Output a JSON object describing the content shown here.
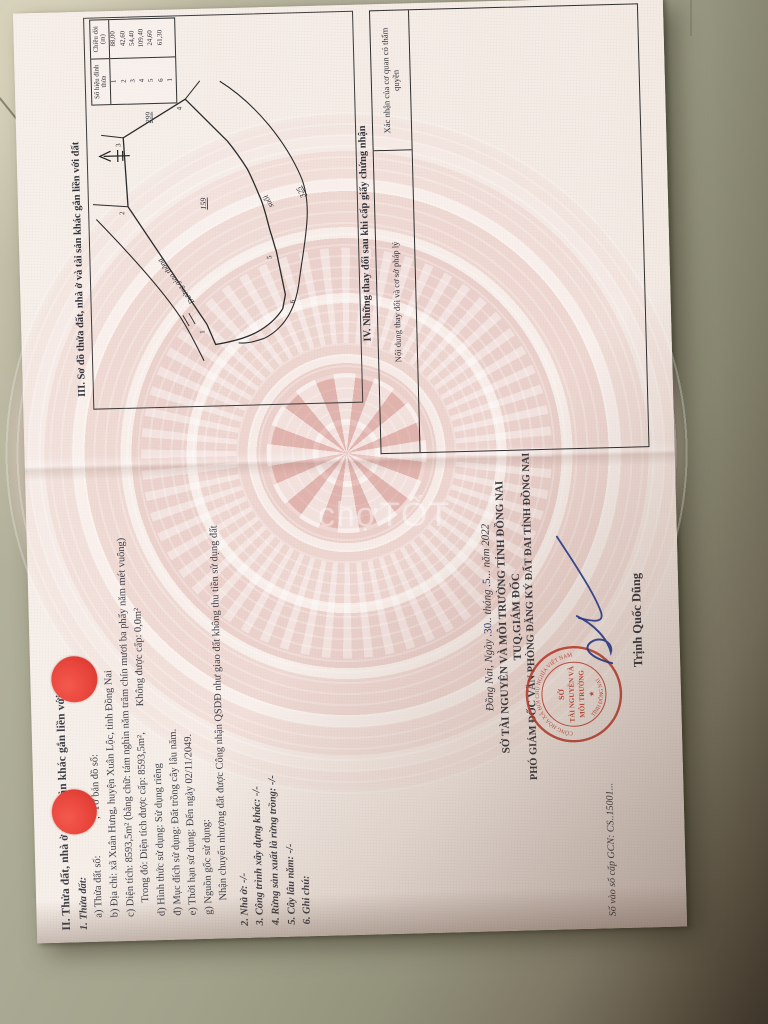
{
  "watermark": "chợTỐT",
  "floor": {
    "tile_color": "#a8a793",
    "shadow_color": "#3e352a"
  },
  "document": {
    "section2": {
      "heading": "II. Thửa đất, nhà ở và tài sản khác gắn liền với đất",
      "lines": [
        "1. Thửa đất:",
        "a) Thửa đất số:              ;  Tờ bản đồ số:",
        "b) Địa chỉ: xã Xuân Hưng, huyện Xuân Lộc, tỉnh Đồng Nai",
        "c) Diện tích: 8593,5m² (bằng chữ: tám nghìn năm trăm chín mươi ba phẩy năm mét vuông)",
        "Trong đó: Diện tích được cấp: 8593,5m²,          Không được cấp: 0,0m²",
        "d) Hình thức sử dụng: Sử dụng riêng",
        "đ) Mục đích sử dụng: Đất trồng cây lâu năm.",
        "e) Thời hạn sử dụng: Đến ngày 02/11/2049.",
        "g) Nguồn gốc sử dụng:",
        "Nhận chuyển nhượng đất được Công nhận QSDĐ như giao đất không thu tiền sử dụng đất",
        "2. Nhà ở: -/-",
        "3. Công trình xây dựng khác: -/-",
        "4. Rừng sản xuất là rừng trồng: -/-",
        "5. Cây lâu năm: -/-",
        "6. Ghi chú:"
      ]
    },
    "issuance": {
      "date_prefix": "Đồng Nai, Ngày .",
      "date_day": "30",
      "date_mid": ".. tháng .",
      "date_month": "5",
      "date_suffix": "... năm 2022",
      "agency": "SỞ TÀI NGUYÊN VÀ MÔI TRƯỜNG TỈNH ĐỒNG NAI",
      "signer_title1": "TUQ.GIÁM ĐỐC",
      "signer_title2": "PHÓ GIÁM ĐỐC VĂN PHÒNG ĐĂNG KÝ ĐẤT ĐAI TỈNH ĐỒNG NAI",
      "signer_name": "Trịnh Quốc Dũng",
      "book_number": "Số vào sổ cấp GCN: CS..15001...",
      "stamp": {
        "ring_top": "CỘNG HÒA XÃ HỘI CHỦ NGHĨA VIỆT NAM",
        "ring_bottom": "TỈNH ĐỒNG NAI",
        "center1": "SỞ",
        "center2": "TÀI NGUYÊN VÀ",
        "center3": "MÔI TRƯỜNG"
      }
    },
    "section3": {
      "title": "III. Sơ đồ thửa đất, nhà ở và tài sản khác gắn liền với đất",
      "measure_table": {
        "col1": "Số hiệu đỉnh thửa",
        "col2": "Chiều dài (m)",
        "rows": [
          [
            "1",
            "88,00"
          ],
          [
            "2",
            "42,60"
          ],
          [
            "3",
            "54,40"
          ],
          [
            "4",
            "109,40"
          ],
          [
            "5",
            "24,60"
          ],
          [
            "6",
            "61,30"
          ],
          [
            "1",
            ""
          ]
        ]
      },
      "labels": {
        "parcel_number": "159",
        "neighbor_parcel_top": "299",
        "neighbor_parcel_right": "325",
        "stream": "suối",
        "road": "Đường giao thông",
        "v1": "1",
        "v2": "2",
        "v3": "3",
        "v4": "4",
        "v5": "5",
        "v6": "6"
      }
    },
    "section4": {
      "title": "IV. Những thay đổi sau khi cấp giấy chứng nhận",
      "col1": "Nội dung thay đổi và cơ sở pháp lý",
      "col2": "Xác nhận của cơ quan có thẩm quyền"
    }
  }
}
